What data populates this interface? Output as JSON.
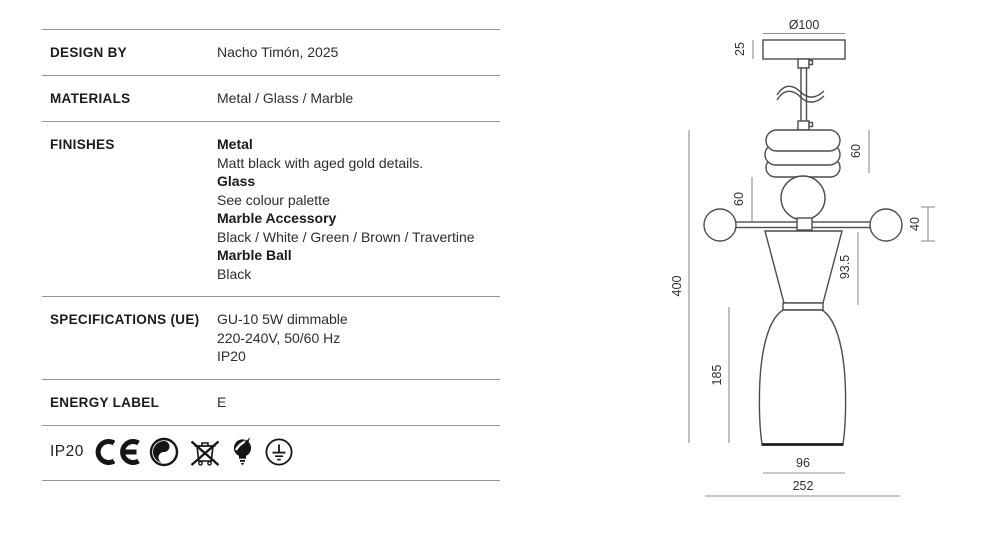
{
  "colors": {
    "table_border": "#969696",
    "drawing_stroke": "#4c4c4c",
    "dimension_line": "#8c8c8c",
    "text_dark": "#1b1b1b"
  },
  "table": {
    "rows": [
      {
        "id": "design-by",
        "label": "DESIGN BY",
        "lines": [
          {
            "text": "Nacho Timón, 2025",
            "bold": false
          }
        ]
      },
      {
        "id": "materials",
        "label": "MATERIALS",
        "lines": [
          {
            "text": "Metal / Glass / Marble",
            "bold": false
          }
        ]
      },
      {
        "id": "finishes",
        "label": "FINISHES",
        "lines": [
          {
            "text": "Metal",
            "bold": true
          },
          {
            "text": "Matt black with aged gold details.",
            "bold": false
          },
          {
            "text": "Glass",
            "bold": true
          },
          {
            "text": "See colour palette",
            "bold": false
          },
          {
            "text": "Marble Accessory",
            "bold": true
          },
          {
            "text": "Black / White / Green / Brown / Travertine",
            "bold": false
          },
          {
            "text": "Marble Ball",
            "bold": true
          },
          {
            "text": "Black",
            "bold": false
          }
        ]
      },
      {
        "id": "specifications",
        "label": "SPECIFICATIONS (UE)",
        "lines": [
          {
            "text": "GU-10 5W dimmable",
            "bold": false
          },
          {
            "text": "220-240V, 50/60 Hz",
            "bold": false
          },
          {
            "text": "IP20",
            "bold": false
          }
        ]
      },
      {
        "id": "energy-label",
        "label": "ENERGY LABEL",
        "lines": [
          {
            "text": "E",
            "bold": false
          }
        ]
      }
    ],
    "certifications": {
      "ip_rating": "IP20",
      "icons": [
        "ce-mark-icon",
        "green-dot-recycling-icon",
        "weee-crossed-bin-icon",
        "light-bulb-icon",
        "protective-earth-icon"
      ]
    }
  },
  "drawing": {
    "dim_canopy_diameter": "Ø100",
    "dim_canopy_height": "25",
    "dim_ring_stack_height": "60",
    "dim_sphere_diameter": "60",
    "dim_arm_ball_diameter": "40",
    "dim_cone_height": "93.5",
    "dim_shade_height": "185",
    "dim_total_height": "400",
    "dim_shade_bottom_width": "96",
    "dim_total_width": "252"
  }
}
